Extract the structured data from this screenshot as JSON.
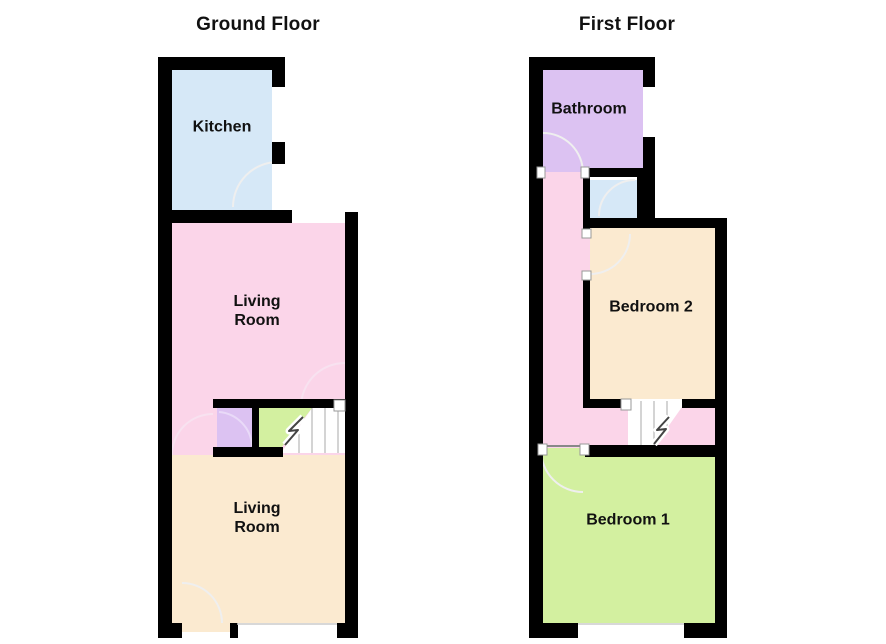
{
  "floors": {
    "ground": {
      "title": "Ground Floor",
      "rooms": {
        "kitchen": "Kitchen",
        "living_upper": "Living\nRoom",
        "living_lower": "Living\nRoom"
      }
    },
    "first": {
      "title": "First Floor",
      "rooms": {
        "bathroom": "Bathroom",
        "bedroom2": "Bedroom 2",
        "bedroom1": "Bedroom 1"
      }
    }
  },
  "colors": {
    "wall": "#000000",
    "kitchen": "#d6e8f7",
    "pink": "#fbd5e9",
    "cream": "#fbead0",
    "green": "#d3f0a0",
    "purple": "#dcc2f2",
    "blue": "#d6e8f7",
    "stairs": "#ffffff",
    "door_arc": "#efefef",
    "pink_arc": "#f8e2f0",
    "purple_arc": "#e9daf8",
    "stair_line": "#aaaaaa",
    "boundary_line": "#888888"
  }
}
